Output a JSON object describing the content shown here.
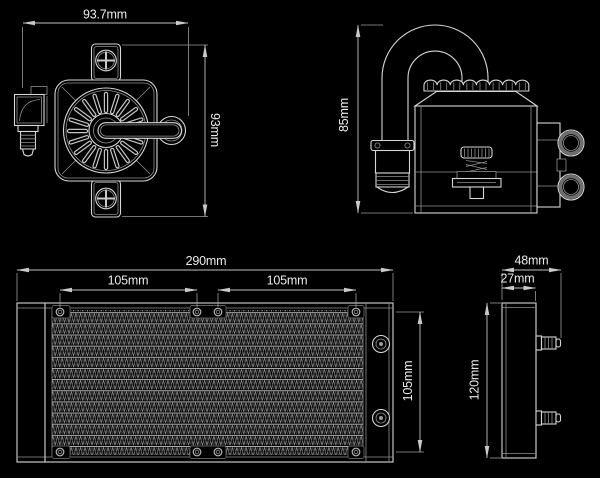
{
  "page": {
    "title": "AIO liquid cooler dimension drawing",
    "background_color": "#000000",
    "line_color": "#d6d6d6",
    "text_color": "#ebebeb"
  },
  "views": {
    "pump_front": {
      "width_dim": "93.7mm",
      "height_dim": "93mm"
    },
    "pump_side": {
      "height_dim": "85mm"
    },
    "radiator_front": {
      "width_dim": "290mm",
      "hole_span_left_dim": "105mm",
      "hole_span_right_dim": "105mm",
      "hole_span_vertical_dim": "105mm"
    },
    "radiator_side": {
      "overall_depth_dim": "48mm",
      "core_depth_dim": "27mm",
      "height_dim": "120mm"
    }
  }
}
